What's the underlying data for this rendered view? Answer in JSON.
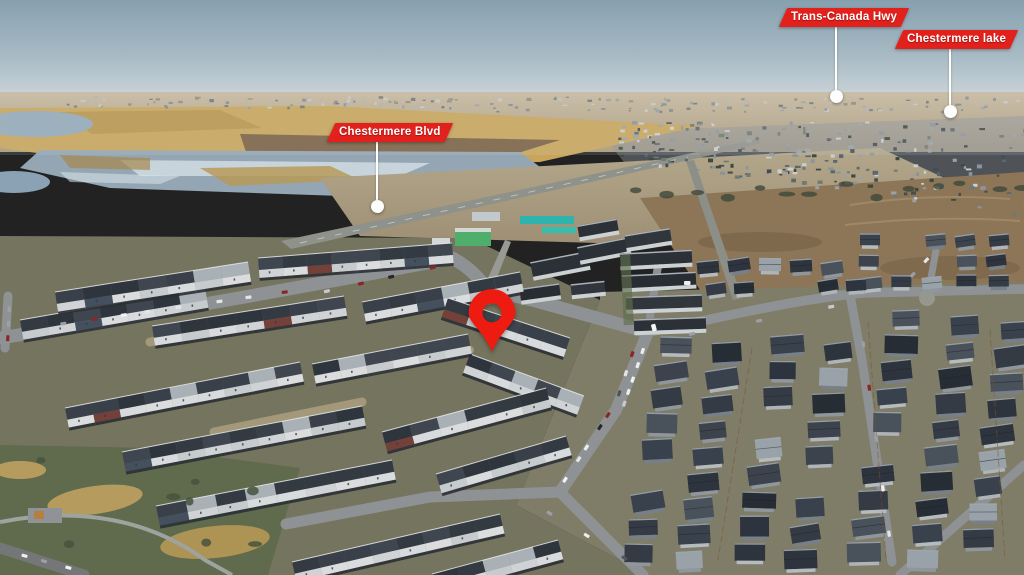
{
  "annotations": {
    "labels": [
      {
        "id": "trans-canada-hwy",
        "text": "Trans-Canada Hwy",
        "box": {
          "x": 783,
          "y": 8
        },
        "line": {
          "x": 836,
          "y1": 27,
          "y2": 90
        },
        "dot": {
          "x": 836,
          "y": 96
        }
      },
      {
        "id": "chestermere-lake",
        "text": "Chestermere lake",
        "box": {
          "x": 899,
          "y": 30
        },
        "line": {
          "x": 950,
          "y1": 49,
          "y2": 105
        },
        "dot": {
          "x": 950,
          "y": 111
        }
      },
      {
        "id": "chestermere-blvd",
        "text": "Chestermere Blvd",
        "box": {
          "x": 331,
          "y": 123
        },
        "line": {
          "x": 377,
          "y1": 142,
          "y2": 200
        },
        "dot": {
          "x": 377,
          "y": 206
        }
      }
    ],
    "pin": {
      "x": 492,
      "tip_y": 354,
      "width": 54,
      "height": 65
    },
    "colors": {
      "label_bg": "#e2211c",
      "label_text": "#ffffff",
      "leader": "#ffffff",
      "pin": "#ee1c10"
    }
  }
}
